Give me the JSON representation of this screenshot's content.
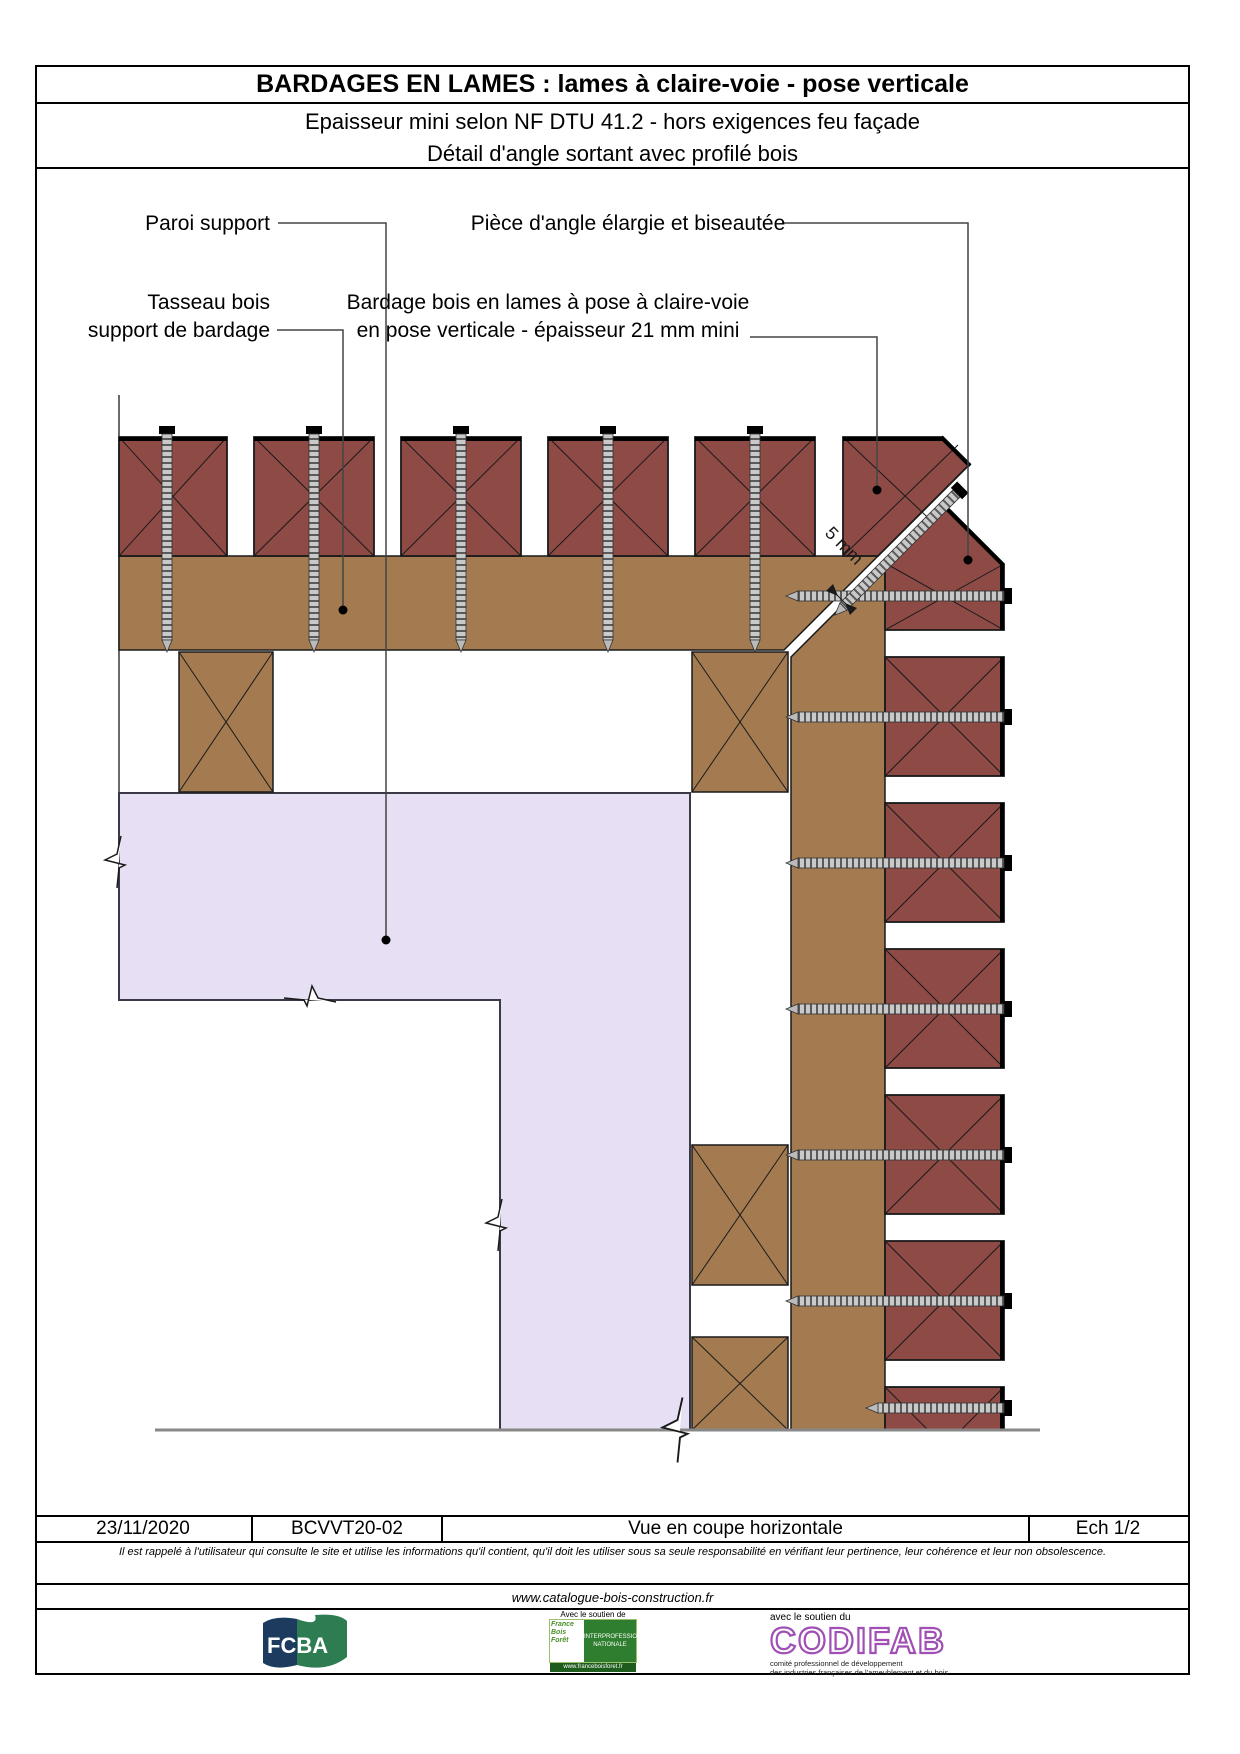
{
  "title_block": {
    "title": "BARDAGES EN LAMES : lames à claire-voie - pose verticale",
    "subtitle1": "Epaisseur mini selon NF DTU 41.2 - hors exigences feu façade",
    "subtitle2": "Détail d'angle sortant avec profilé bois"
  },
  "drawing": {
    "labels": {
      "paroi": "Paroi support",
      "piece_angle": "Pièce d'angle élargie et biseautée",
      "tasseau_line1": "Tasseau bois",
      "tasseau_line2": "support de bardage",
      "bardage_line1": "Bardage bois en lames à pose à claire-voie",
      "bardage_line2": "en pose verticale - épaisseur 21 mm mini",
      "gap_dim": "5 mm"
    },
    "colors": {
      "lame": "#8E4A45",
      "batten": "#A47B50",
      "wall": "#E7DFF4",
      "outline": "#1a1a1a",
      "baseline": "#888888",
      "screw_body": "#c9c9c9"
    },
    "counts": {
      "top_boards": 6,
      "right_boards": 7,
      "top_screws": 5,
      "right_screws": 7
    }
  },
  "footer": {
    "date": "23/11/2020",
    "reference": "BCVVT20-02",
    "view": "Vue en coupe horizontale",
    "scale": "Ech 1/2",
    "disclaimer": "Il est rappelé à l'utilisateur qui consulte le site et utilise les informations qu'il contient, qu'il doit les utiliser sous sa seule responsabilité en vérifiant leur pertinence, leur cohérence et leur non obsolescence.",
    "website": "www.catalogue-bois-construction.fr"
  },
  "logos": {
    "fcba": "FCBA",
    "fbf_support": "Avec le soutien de",
    "fbf_name1": "France",
    "fbf_name2": "Bois",
    "fbf_name3": "Forêt",
    "fbf_inter1": "INTERPROFESSION",
    "fbf_inter2": "NATIONALE",
    "fbf_url": "www.franceboisforet.fr",
    "codifab_support": "avec le soutien du",
    "codifab": "CODIFAB",
    "codifab_sub1": "comité professionnel de développement",
    "codifab_sub2": "des industries françaises de l'ameublement et du bois"
  }
}
